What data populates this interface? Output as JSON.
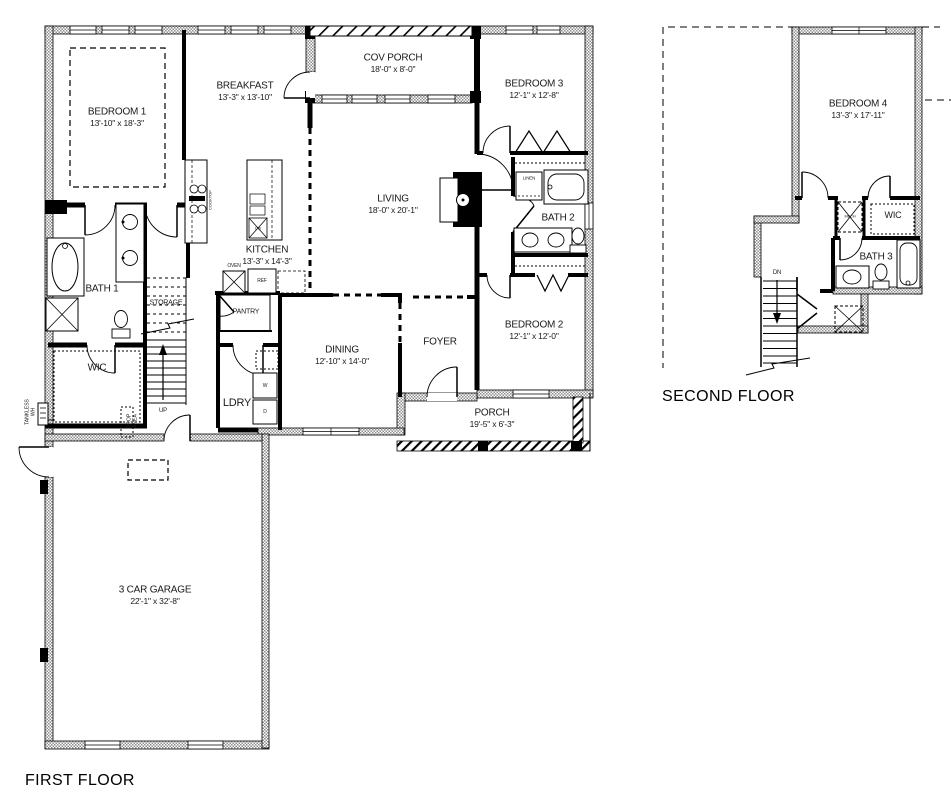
{
  "colors": {
    "background": "#ffffff",
    "line": "#000000",
    "wall_fill": "#8f8f8f"
  },
  "first_floor": {
    "caption": "FIRST FLOOR",
    "rooms": {
      "bedroom1": {
        "name": "BEDROOM 1",
        "dims": "13'-10\" x 18'-3\""
      },
      "breakfast": {
        "name": "BREAKFAST",
        "dims": "13'-3\" x 13'-10\""
      },
      "cov_porch": {
        "name": "COV PORCH",
        "dims": "18'-0\" x 8'-0\""
      },
      "bedroom3": {
        "name": "BEDROOM 3",
        "dims": "12'-1\" x 12'-8\""
      },
      "living": {
        "name": "LIVING",
        "dims": "18'-0\" x 20'-1\""
      },
      "kitchen": {
        "name": "KITCHEN",
        "dims": "13'-3\" x 14'-3\""
      },
      "dining": {
        "name": "DINING",
        "dims": "12'-10\" x 14'-0\""
      },
      "foyer": {
        "name": "FOYER"
      },
      "bedroom2": {
        "name": "BEDROOM 2",
        "dims": "12'-1\" x 12'-0\""
      },
      "porch": {
        "name": "PORCH",
        "dims": "19'-5\" x 6'-3\""
      },
      "garage": {
        "name": "3 CAR GARAGE",
        "dims": "22'-1\" x 32'-8\""
      },
      "bath1": {
        "name": "BATH 1"
      },
      "bath2": {
        "name": "BATH 2"
      },
      "wic": {
        "name": "WIC"
      },
      "pantry": {
        "name": "PANTRY"
      },
      "laundry": {
        "name": "LDRY"
      },
      "storage": {
        "name": "STORAGE"
      },
      "linen": {
        "name": "LINEN"
      }
    },
    "annotations": {
      "up": "UP",
      "oven": "OVEN",
      "ref": "REF",
      "dw": "DW",
      "washer": "W",
      "dryer": "D",
      "cooktop": "COOKTOP",
      "drop_line1": "DROP",
      "drop_line2": "AREA",
      "tankless_line1": "TANKLESS",
      "tankless_line2": "WH"
    }
  },
  "second_floor": {
    "caption": "SECOND FLOOR",
    "rooms": {
      "bedroom4": {
        "name": "BEDROOM 4",
        "dims": "13'-3\" x 17'-11\""
      },
      "wic": {
        "name": "WIC"
      },
      "bath3": {
        "name": "BATH 3"
      },
      "mech": {
        "name": "MECH"
      }
    },
    "annotations": {
      "dn": "DN"
    }
  }
}
